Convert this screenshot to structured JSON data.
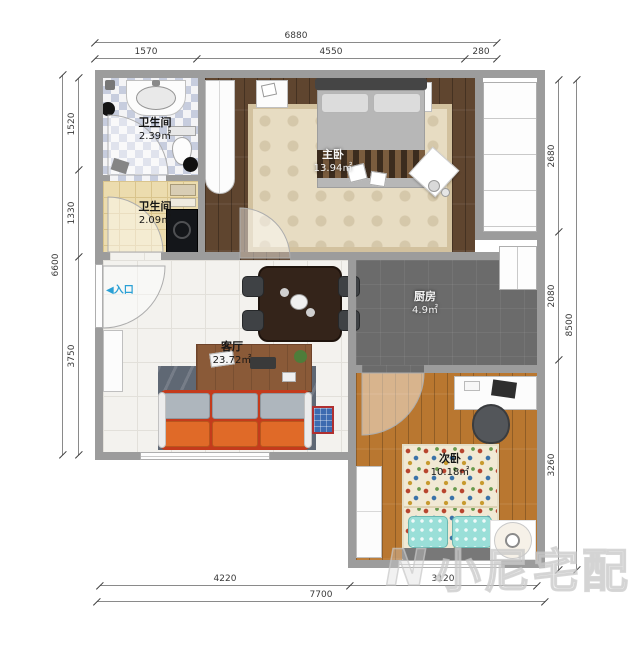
{
  "rooms": {
    "bathroom_top": {
      "name": "卫生间",
      "area": "2.39㎡"
    },
    "bathroom_mid": {
      "name": "卫生间",
      "area": "2.09㎡"
    },
    "master_bedroom": {
      "name": "主卧",
      "area": "13.94㎡"
    },
    "kitchen": {
      "name": "厨房",
      "area": "4.9㎡"
    },
    "living_room": {
      "name": "客厅",
      "area": "23.72㎡"
    },
    "second_bedroom": {
      "name": "次卧",
      "area": "10.18㎡"
    }
  },
  "entrance": {
    "arrow": "◀",
    "label": "入口"
  },
  "dimensions": {
    "top": {
      "overall": "6880",
      "segments": [
        "1570",
        "4550",
        "280"
      ]
    },
    "left": {
      "overall": "6600",
      "segments": [
        "1520",
        "1330",
        "3750"
      ]
    },
    "right": {
      "overall": "8500",
      "segments": [
        "2680",
        "2080",
        "3260"
      ]
    },
    "bottom": {
      "overall": "7700",
      "segments": [
        "4220",
        "3120"
      ]
    }
  },
  "watermark": {
    "logo": "N",
    "text": "小尼宅配"
  },
  "colors": {
    "wall": "#9c9c9c",
    "master_floor": "#5f452f",
    "second_bedroom_floor": "#b97730",
    "kitchen_floor": "#6b6b6b",
    "living_tile": "#f3f2ee",
    "sofa_orange": "#e06a28",
    "sofa_frame_red": "#c43b1c",
    "entrance_blue": "#2aa0d5",
    "watermark_gray": "#cccccc"
  }
}
